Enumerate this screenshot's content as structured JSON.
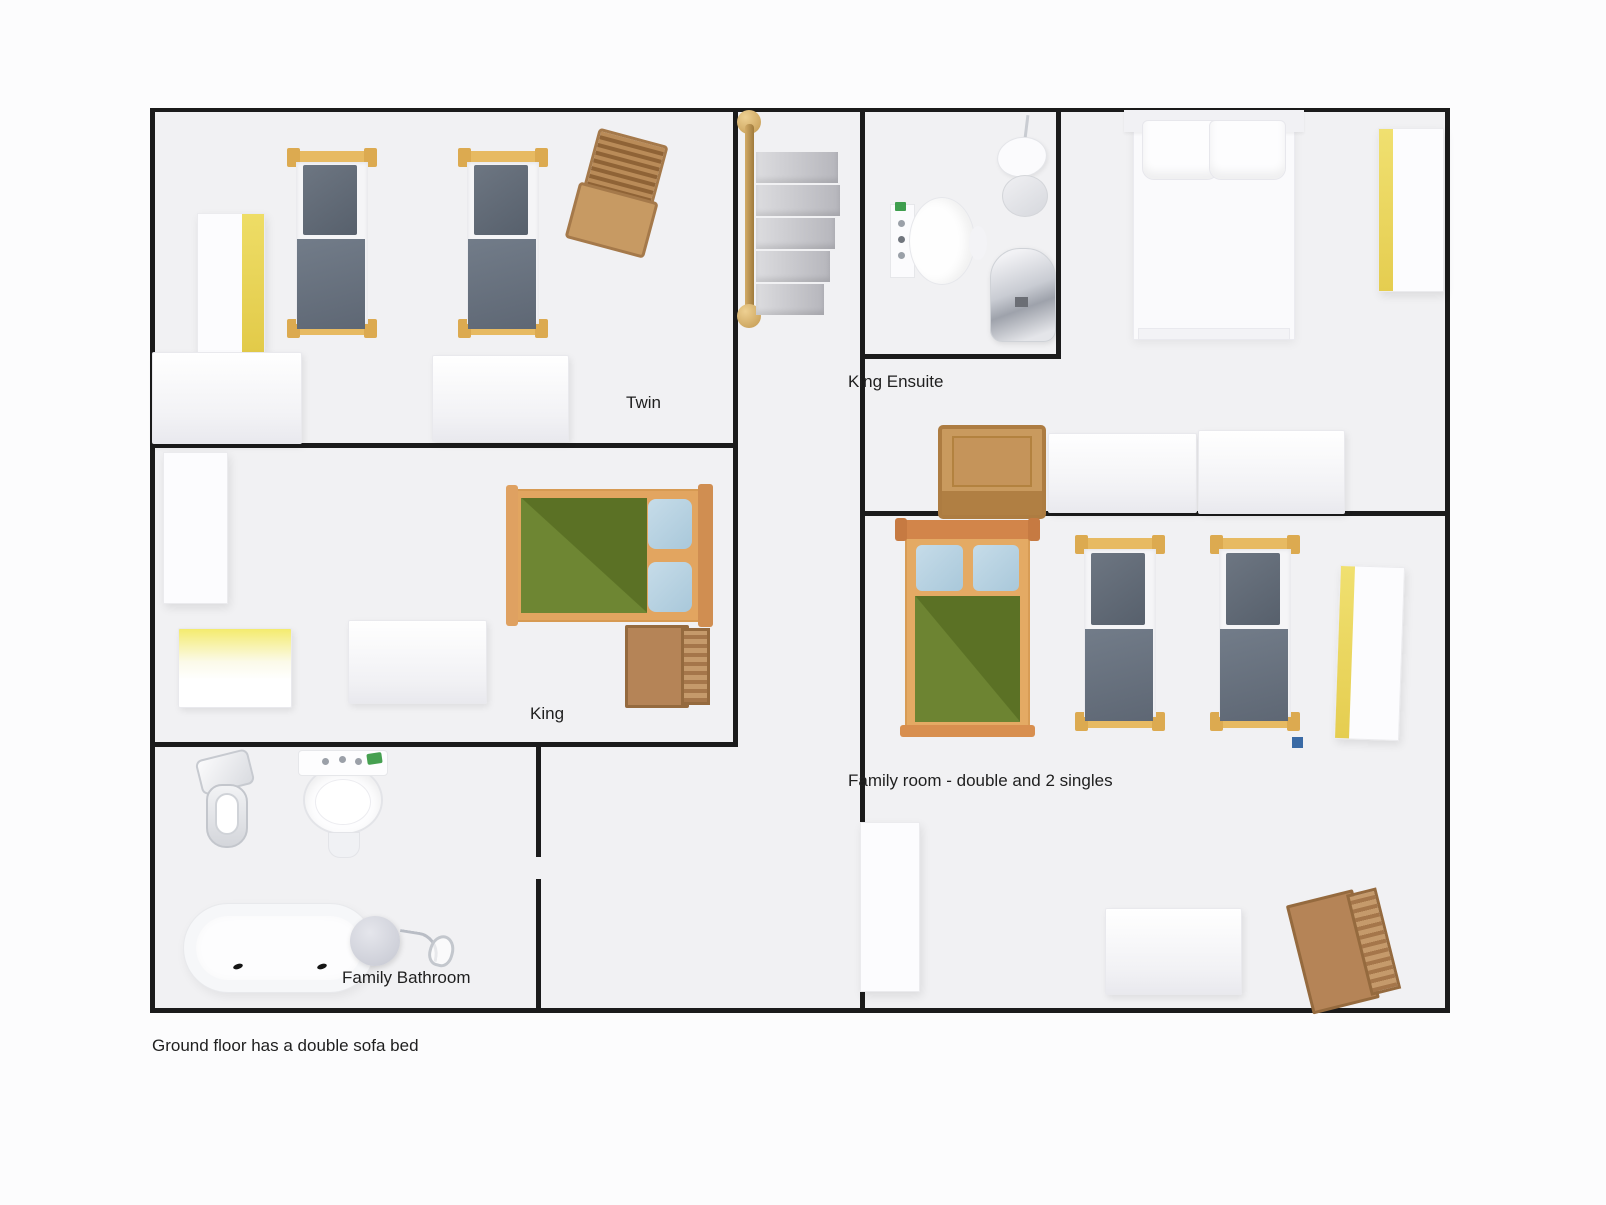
{
  "footnote": "Ground floor has a double sofa bed",
  "rooms": {
    "twin": {
      "label": "Twin",
      "furniture": [
        "wardrobe-yellow-door",
        "single-bed",
        "single-bed",
        "folding-chair",
        "chest-of-drawers",
        "chest-of-drawers"
      ]
    },
    "king": {
      "label": "King",
      "furniture": [
        "wardrobe",
        "double-bed-green",
        "chest-of-drawers-yellow-top",
        "chest-of-drawers",
        "folded-chair"
      ]
    },
    "family_bathroom": {
      "label": "Family Bathroom",
      "furniture": [
        "toilet",
        "basin",
        "bathtub",
        "stool",
        "shower-mixer"
      ]
    },
    "king_ensuite": {
      "label": "King Ensuite",
      "furniture": [
        "toilet",
        "pedestal-sink",
        "chrome-bidet",
        "king-bed-white",
        "wardrobe-yellow-door",
        "deck-chair",
        "chest-of-drawers",
        "chest-of-drawers"
      ]
    },
    "family_room": {
      "label": "Family room - double and 2 singles",
      "furniture": [
        "double-bed-green",
        "single-bed",
        "single-bed",
        "wardrobe-yellow-door",
        "wardrobe",
        "chest-of-drawers",
        "folded-chair",
        "blue-marker"
      ]
    },
    "landing": {
      "label": "",
      "furniture": [
        "brass-rail-shelf-unit"
      ]
    }
  },
  "colors": {
    "wall": "#1b1b1b",
    "plan_background": "#f1f1f3",
    "page_background": "#fcfcfd",
    "bed_frame_tan": "#e7ba62",
    "bed_frame_orange": "#d2854a",
    "duvet_grey": "#68717e",
    "duvet_green": "#5b7125",
    "pillow_blue": "#b7d2e2",
    "wardrobe_yellow": "#e8d455",
    "marker_blue": "#3a6aa5",
    "label_text": "#1f1f1f"
  }
}
